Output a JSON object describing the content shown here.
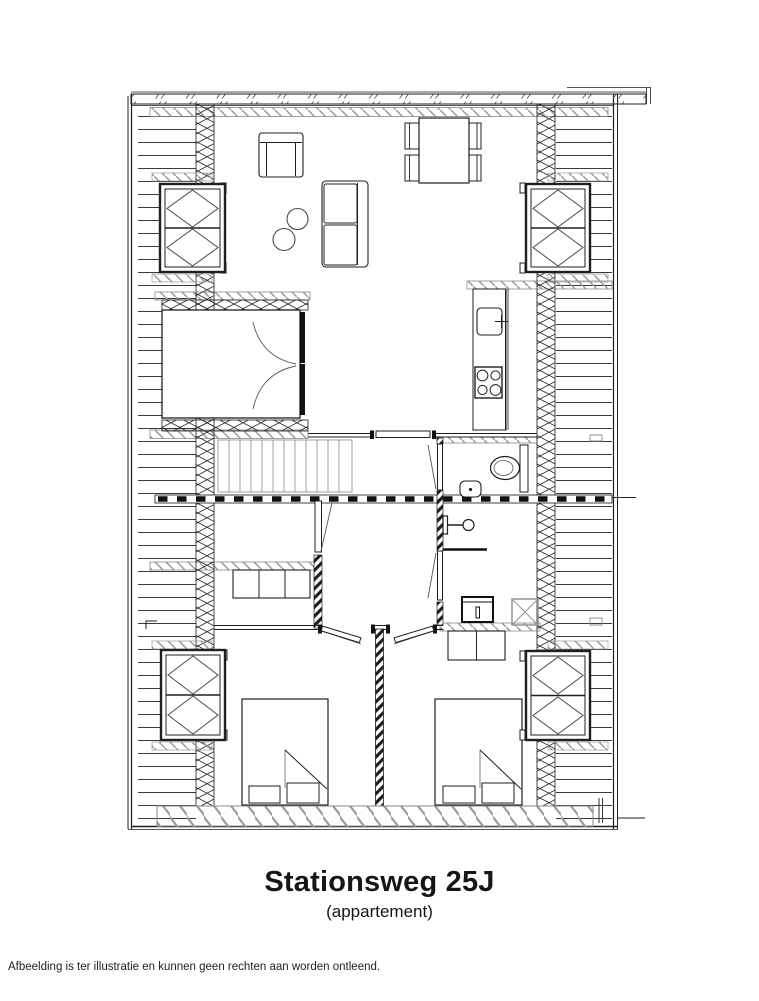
{
  "floorplan": {
    "title": "Stationsweg 25J",
    "subtitle": "(appartement)",
    "disclaimer": "Afbeelding is ter illustratie en kunnen geen rechten aan worden ontleend.",
    "colors": {
      "ink": "#1f1f1f",
      "wall_hatch": "#2b2b2b",
      "beam_hatch_gray": "#9a9a9a",
      "stair_tread_gray": "#9f9f9f",
      "background": "#ffffff"
    }
  }
}
